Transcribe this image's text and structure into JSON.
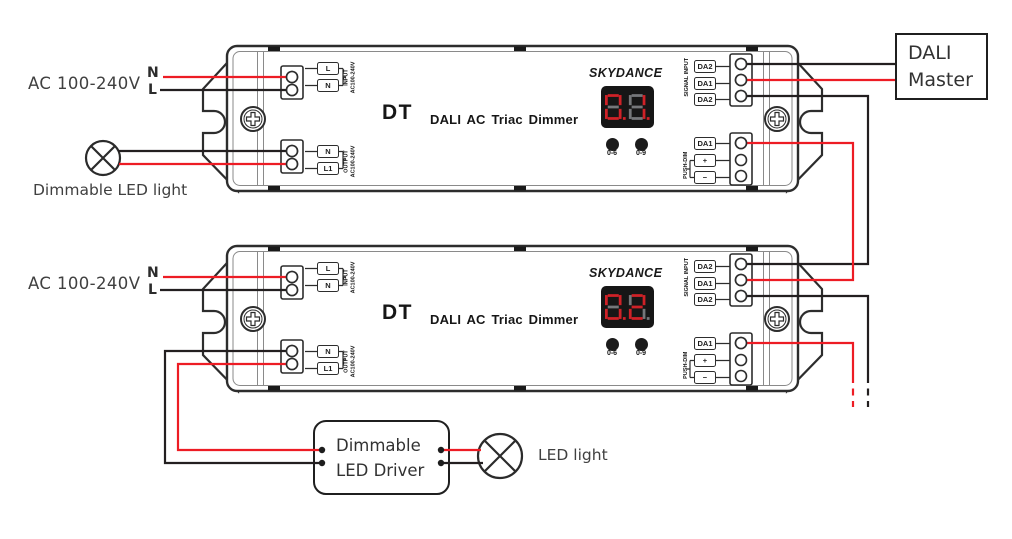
{
  "colors": {
    "wire_red": "#ed1c24",
    "wire_black": "#231f20",
    "outline": "#2d2d2d",
    "display_bg": "#161616",
    "seg_on": "#cf2127",
    "seg_off": "#75777a"
  },
  "labels": {
    "ac_unit1": "AC 100-240V",
    "ac_unit2": "AC 100-240V",
    "neutral": "N",
    "live": "L",
    "lamp1": "Dimmable LED light",
    "lamp2": "LED light"
  },
  "dali_master": {
    "line1": "DALI",
    "line2": "Master"
  },
  "led_driver": {
    "line1": "Dimmable",
    "line2": "LED Driver"
  },
  "device": {
    "brand": "SKYDANCE",
    "model": "DT",
    "product_name": "DALI AC Triac Dimmer",
    "input_terminal_top": "L",
    "input_terminal_bottom": "N",
    "input_note_main": "AC100-240V",
    "input_note_sub": "INPUT",
    "output_terminal_top": "N",
    "output_terminal_bottom": "L1",
    "output_note_main": "AC100-240V",
    "output_note_sub": "OUTPUT",
    "signal_note": "SIGNAL INPUT",
    "signal_terminals": [
      "DA2",
      "DA1",
      "DA2"
    ],
    "pushdim_note": "PUSH-DIM",
    "pushdim_terminal": "DA1",
    "pushdim_plus": "+",
    "pushdim_minus": "−",
    "button_left": "0-6",
    "button_right": "0-9"
  },
  "units": [
    {
      "id": "dimmer-1",
      "display_value": "01",
      "digits": [
        {
          "lit": "abcdef",
          "dp": true
        },
        {
          "lit": "bc",
          "dp": true
        }
      ]
    },
    {
      "id": "dimmer-2",
      "display_value": "02",
      "digits": [
        {
          "lit": "abcdef",
          "dp": true
        },
        {
          "lit": "abged",
          "dp": false
        }
      ]
    }
  ]
}
